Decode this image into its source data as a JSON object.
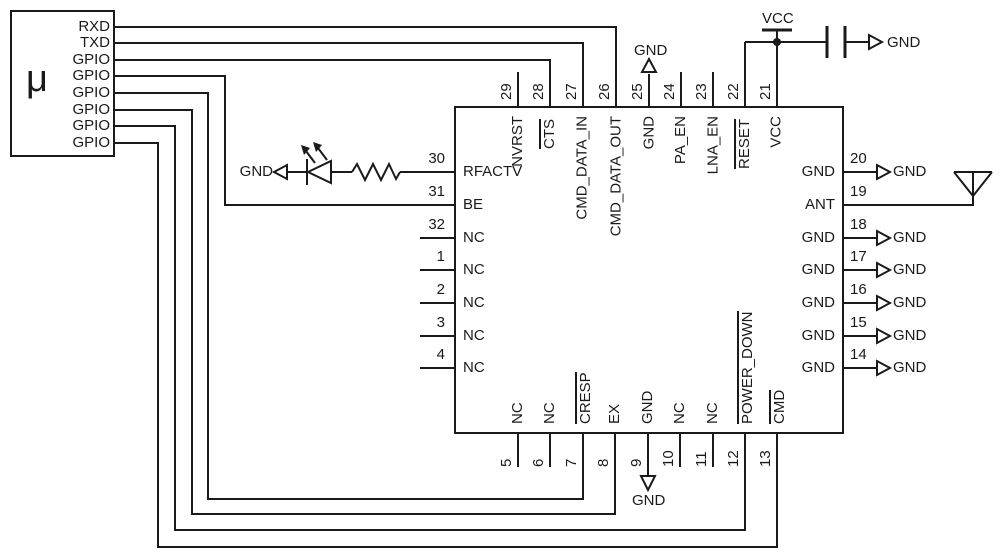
{
  "colors": {
    "line": "#1a1a1a",
    "background": "#ffffff"
  },
  "nets": {
    "gnd": "GND",
    "vcc": "VCC"
  },
  "mcu": {
    "symbol": "μ",
    "pins": [
      "RXD",
      "TXD",
      "GPIO",
      "GPIO",
      "GPIO",
      "GPIO",
      "GPIO",
      "GPIO"
    ]
  },
  "ic": {
    "top_pins": [
      {
        "num": "29",
        "name": "NVRST",
        "overline": false
      },
      {
        "num": "28",
        "name": "CTS",
        "overline": true
      },
      {
        "num": "27",
        "name": "CMD_DATA_IN",
        "overline": false
      },
      {
        "num": "26",
        "name": "CMD_DATA_OUT",
        "overline": false
      },
      {
        "num": "25",
        "name": "GND",
        "overline": false
      },
      {
        "num": "24",
        "name": "PA_EN",
        "overline": false
      },
      {
        "num": "23",
        "name": "LNA_EN",
        "overline": false
      },
      {
        "num": "22",
        "name": "RESET",
        "overline": true
      },
      {
        "num": "21",
        "name": "VCC",
        "overline": false
      }
    ],
    "left_pins": [
      {
        "num": "30",
        "name": "RFACTV"
      },
      {
        "num": "31",
        "name": "BE"
      },
      {
        "num": "32",
        "name": "NC"
      },
      {
        "num": "1",
        "name": "NC"
      },
      {
        "num": "2",
        "name": "NC"
      },
      {
        "num": "3",
        "name": "NC"
      },
      {
        "num": "4",
        "name": "NC"
      }
    ],
    "right_pins": [
      {
        "num": "20",
        "name": "GND"
      },
      {
        "num": "19",
        "name": "ANT"
      },
      {
        "num": "18",
        "name": "GND"
      },
      {
        "num": "17",
        "name": "GND"
      },
      {
        "num": "16",
        "name": "GND"
      },
      {
        "num": "15",
        "name": "GND"
      },
      {
        "num": "14",
        "name": "GND"
      }
    ],
    "bottom_pins": [
      {
        "num": "5",
        "name": "NC",
        "overline": false
      },
      {
        "num": "6",
        "name": "NC",
        "overline": false
      },
      {
        "num": "7",
        "name": "CRESP",
        "overline": true
      },
      {
        "num": "8",
        "name": "EX",
        "overline": false
      },
      {
        "num": "9",
        "name": "GND",
        "overline": false
      },
      {
        "num": "10",
        "name": "NC",
        "overline": false
      },
      {
        "num": "11",
        "name": "NC",
        "overline": false
      },
      {
        "num": "12",
        "name": "POWER_DOWN",
        "overline": true
      },
      {
        "num": "13",
        "name": "CMD",
        "overline": true
      }
    ]
  }
}
